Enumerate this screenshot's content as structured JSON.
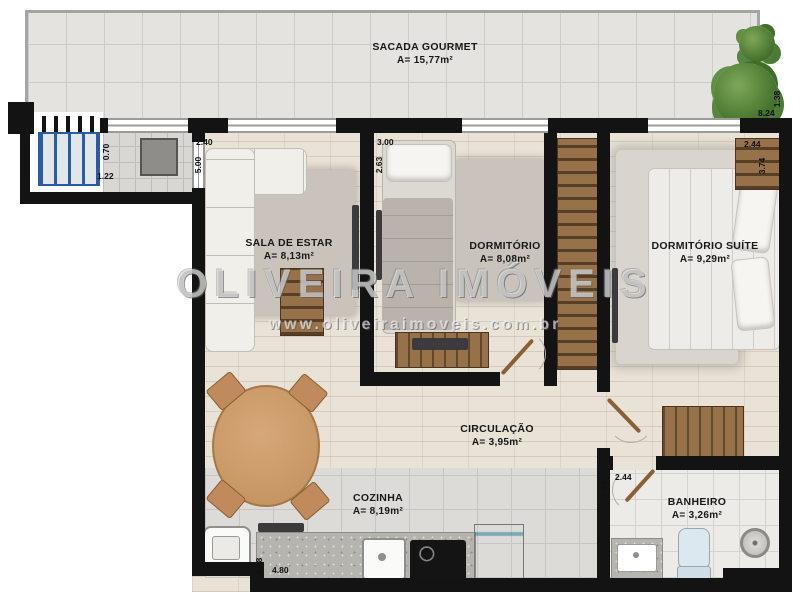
{
  "watermark": {
    "brand": "OLIVEIRA IMÓVEIS",
    "url": "www.oliveiraimoveis.com.br"
  },
  "rooms": {
    "sacada": {
      "name": "SACADA GOURMET",
      "area": "A= 15,77m²"
    },
    "sala": {
      "name": "SALA DE ESTAR",
      "area": "A= 8,13m²"
    },
    "dormitorio": {
      "name": "DORMITÓRIO",
      "area": "A= 8,08m²"
    },
    "suite": {
      "name": "DORMITÓRIO SUÍTE",
      "area": "A= 9,29m²"
    },
    "circulacao": {
      "name": "CIRCULAÇÃO",
      "area": "A= 3,95m²"
    },
    "cozinha": {
      "name": "COZINHA",
      "area": "A= 8,19m²"
    },
    "banheiro": {
      "name": "BANHEIRO",
      "area": "A= 3,26m²"
    }
  },
  "dimensions": {
    "sala_top": "2.40",
    "sala_left": "5.00",
    "dorm_top": "3.00",
    "dorm_left": "2.63",
    "suite_shelf_top": "2.44",
    "suite_shelf_side": "3.74",
    "ladder_width": "0.70",
    "ladder_depth": "1.22",
    "balcony_side": "1.38",
    "balcony_length": "8.24",
    "bath_top": "2.44",
    "bath_side": "1.40",
    "kitchen_step": "0.28",
    "kitchen_length": "4.80"
  },
  "colors": {
    "wall": "#131313",
    "ladder_blue": "#2a5ca5",
    "plant_green": "#49772f",
    "wood_furniture": "#96714a",
    "door_brown": "#8a5f33",
    "floor_wood": "#e8e2d7"
  }
}
